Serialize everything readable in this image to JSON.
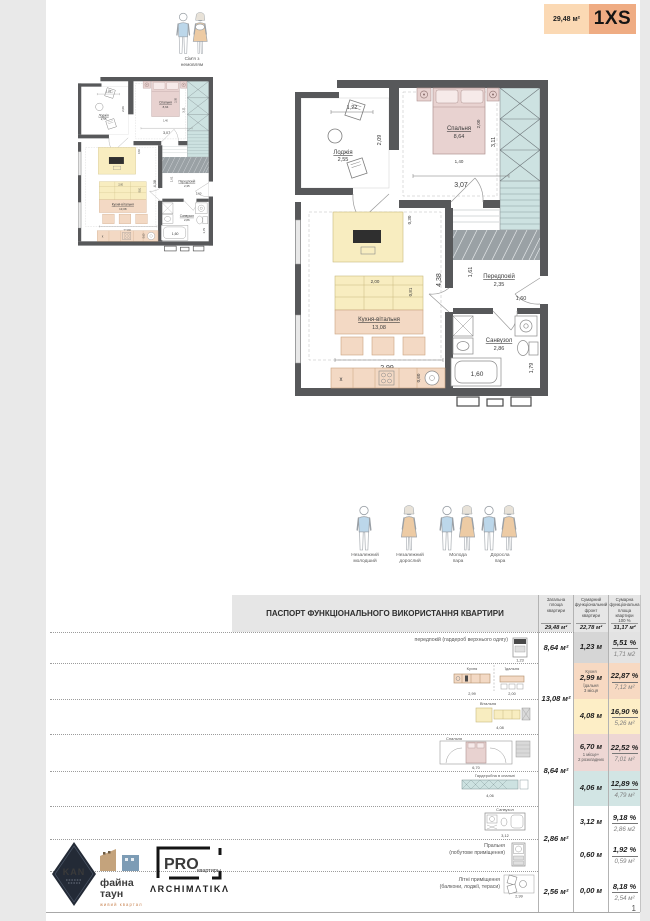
{
  "page": {
    "number": "1"
  },
  "badge": {
    "area": "29,48 м²",
    "type": "1XS"
  },
  "family_icon": {
    "line1": "Сім'я з",
    "line2": "немовлям"
  },
  "plan": {
    "loggia": {
      "name": "Лоджія",
      "area": "2,55"
    },
    "bedroom": {
      "name": "Спальня",
      "area": "8,64"
    },
    "hallway": {
      "name": "Передпокій",
      "area": "2,35"
    },
    "kitchen": {
      "name": "Кухня-вітальня",
      "area": "13,08"
    },
    "bathroom": {
      "name": "Санвузол",
      "area": "2,86"
    },
    "dims": {
      "loggia_width": "1,22",
      "loggia_depth": "2,09",
      "bed_length": "2,00",
      "bed_width": "1,40",
      "bedroom_width": "3,07",
      "bedroom_depth": "3,11",
      "hall_depth": "1,61",
      "hall_width": "1,60",
      "kitchen_width": "2,99",
      "kitchen_depth": "4,38",
      "sofa_width": "2,00",
      "sofa_depth": "0,81",
      "counter_offset": "0,30",
      "sink_width": "0,60",
      "bath_width": "1,60",
      "bath_depth": "1,79",
      "fridge_mark": "x"
    }
  },
  "residents": [
    {
      "line1": "Незалежний",
      "line2": "молодший"
    },
    {
      "line1": "Незалежний",
      "line2": "дорослий"
    },
    {
      "line1": "Молода",
      "line2": "пара"
    },
    {
      "line1": "Доросла",
      "line2": "пара"
    }
  ],
  "table": {
    "title": "ПАСПОРТ ФУНКЦІОНАЛЬНОГО ВИКОРИСТАННЯ КВАРТИРИ",
    "columns": [
      {
        "label": "Загальна\nплоща\nквартири",
        "value": "29,48 м²"
      },
      {
        "label": "Сумарний\nфункціональний\nфронт\nквартири",
        "value": "22,78 м²"
      },
      {
        "label": "Сумарна\nфункціональна\nплоща квартири\n100 %",
        "value": "31,17 м²"
      }
    ],
    "groups": [
      {
        "area": "8,64 м²"
      },
      {
        "area": "13,08 м²"
      },
      {
        "area": "8,64 м²"
      },
      {
        "area": "2,86 м²"
      },
      {
        "area": "2,56 м²"
      }
    ],
    "rows": [
      {
        "label": "передпокій (гардероб верхнього одягу)",
        "front": "1,23 м",
        "percent": "5,51 %",
        "area_share": "1,71 м2",
        "diagram_dim": "1,23"
      },
      {
        "diagram_label_a": "Кухня",
        "diagram_label_b": "Їдальня",
        "front_top": "Кухня",
        "front": "2,99 м",
        "front_sub": "Їдальня\n3 місця",
        "percent": "22,87 %",
        "area_share": "7,12 м²",
        "diagram_dim_a": "2,99",
        "diagram_dim_b": "2,00"
      },
      {
        "diagram_label": "Вітальня",
        "front": "4,08 м",
        "percent": "16,90 %",
        "area_share": "5,26 м²",
        "diagram_dim": "4,08"
      },
      {
        "diagram_label": "Спальня",
        "front": "6,70 м",
        "front_sub": "1 місце+\n2 розкладних",
        "percent": "22,52 %",
        "area_share": "7,01 м²",
        "diagram_dim": "6,70"
      },
      {
        "diagram_label": "Гардеробна в спальні",
        "front": "4,06 м",
        "percent": "12,89 %",
        "area_share": "4,79 м²",
        "diagram_dim": "4,06"
      },
      {
        "diagram_label": "Санвузол",
        "front": "3,12 м",
        "percent": "9,18 %",
        "area_share": "2,86 м2",
        "diagram_dim": "3,12"
      },
      {
        "label": "Пральня\n(побутове приміщення)",
        "front": "0,60 м",
        "percent": "1,92 %",
        "area_share": "0,59 м²"
      },
      {
        "label": "Літні приміщення\n(балкони, лоджії, тераси)",
        "front": "0,00 м",
        "percent": "8,18 %",
        "area_share": "2,54 м²",
        "diagram_dim": "2,99"
      }
    ]
  },
  "logos": {
    "kan": "KAN",
    "faina_line1": "файна",
    "faina_line2": "таун",
    "faina_sub": "живий квартал",
    "pro": "PRO",
    "pro_sub": "квартиры",
    "archimatika": "ΛRCHIMΛTIKΛ"
  }
}
